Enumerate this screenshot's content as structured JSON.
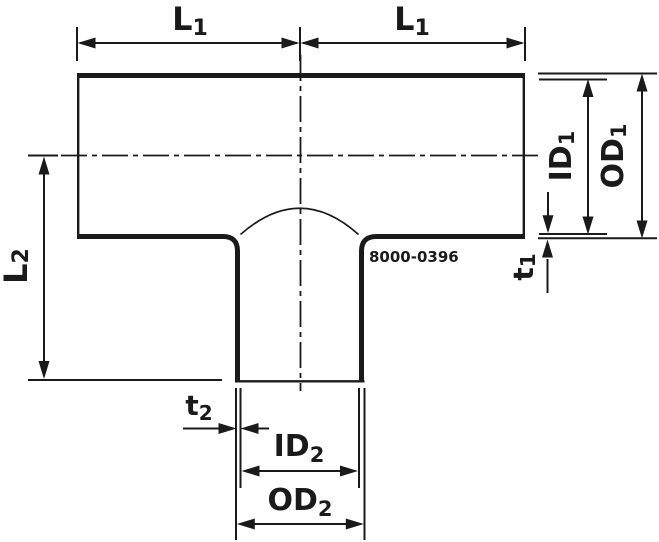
{
  "drawing": {
    "part_number": "8000-0396",
    "dimension_labels": {
      "l1_left": {
        "main": "L",
        "sub": "1"
      },
      "l1_right": {
        "main": "L",
        "sub": "1"
      },
      "l2": {
        "main": "L",
        "sub": "2"
      },
      "id1": {
        "main": "ID",
        "sub": "1"
      },
      "od1": {
        "main": "OD",
        "sub": "1"
      },
      "t1": {
        "main": "t",
        "sub": "1"
      },
      "t2": {
        "main": "t",
        "sub": "2"
      },
      "id2": {
        "main": "ID",
        "sub": "2"
      },
      "od2": {
        "main": "OD",
        "sub": "2"
      }
    },
    "colors": {
      "line": "#1a1a1a",
      "background": "#ffffff"
    }
  }
}
